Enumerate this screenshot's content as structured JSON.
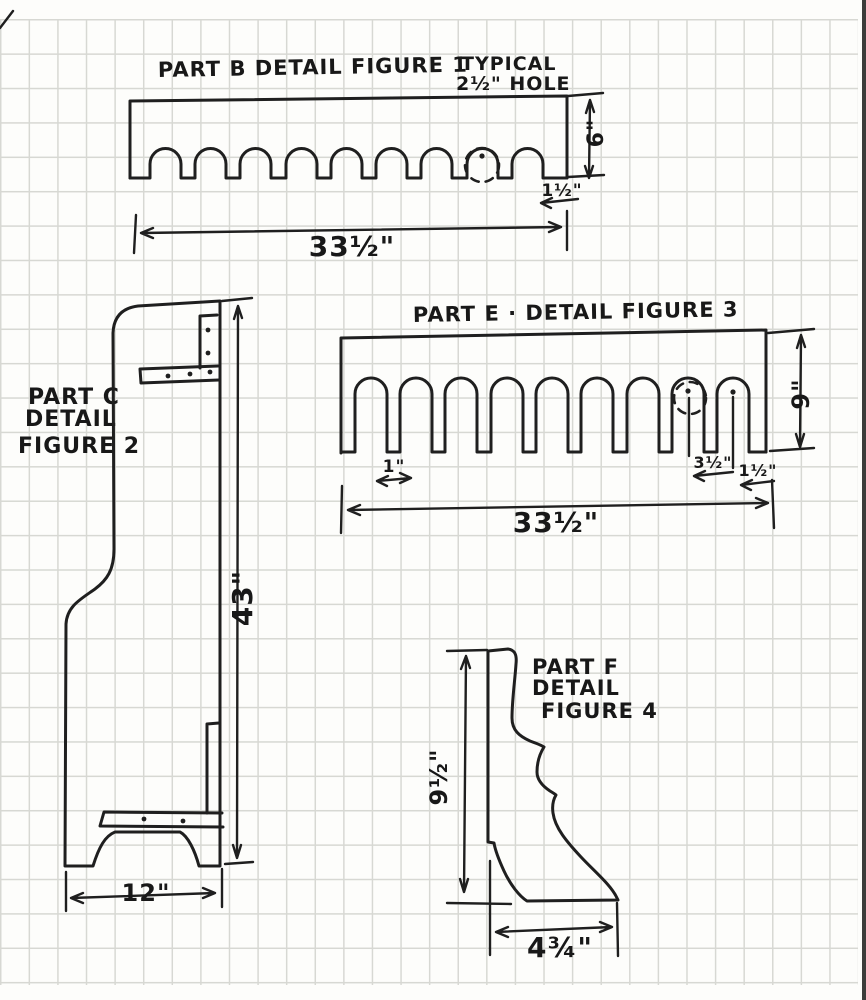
{
  "figure1": {
    "title": "PART B DETAIL FIGURE 1",
    "note_line1": "TYPICAL",
    "note_line2": "2½\" HOLE",
    "height_dim": "6\"",
    "end_margin_dim": "1½\"",
    "width_dim": "33½\""
  },
  "figure2": {
    "label_line1": "PART C",
    "label_line2": "DETAIL",
    "label_line3": "FIGURE 2",
    "height_dim": "43\"",
    "width_dim": "12\""
  },
  "figure3": {
    "title": "PART E · DETAIL FIGURE 3",
    "slot_tab_dim": "1\"",
    "hole_spacing_dim": "3½\"",
    "end_margin_dim": "1½\"",
    "width_dim": "33½\"",
    "height_dim": "9\""
  },
  "figure4": {
    "label_line1": "PART F",
    "label_line2": "DETAIL",
    "label_line3": "FIGURE 4",
    "height_dim": "9½\"",
    "width_dim": "4¾\""
  }
}
